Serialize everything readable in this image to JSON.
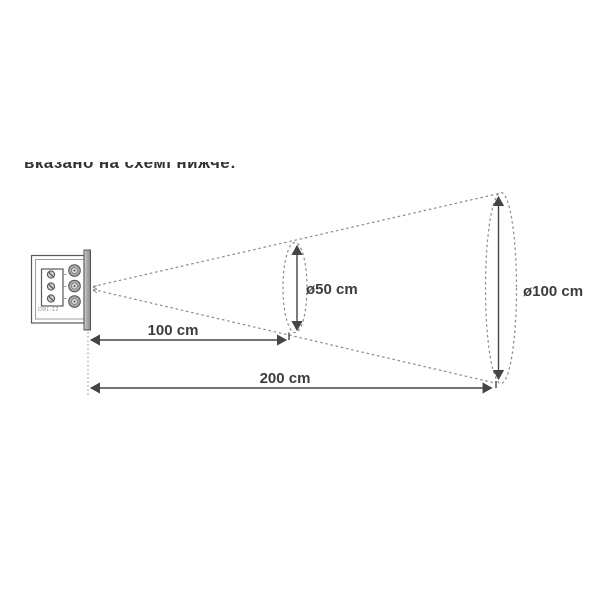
{
  "header": {
    "clipped_line": "вказано на схемі нижче:"
  },
  "diagram": {
    "device": {
      "model_label": "DRL-12"
    },
    "beam": {
      "mid_diameter_label": "ø50 cm",
      "far_diameter_label": "ø100 cm",
      "mid_distance_label": "100 cm",
      "far_distance_label": "200 cm",
      "measurements": [
        {
          "distance_cm": 100,
          "beam_diameter_cm": 50
        },
        {
          "distance_cm": 200,
          "beam_diameter_cm": 100
        }
      ]
    },
    "colors": {
      "outline": "#8a8a8a",
      "device_line": "#5a5a5a",
      "dimension_line": "#454545",
      "label_text": "#3c3c3c",
      "title_text": "#333333"
    }
  }
}
